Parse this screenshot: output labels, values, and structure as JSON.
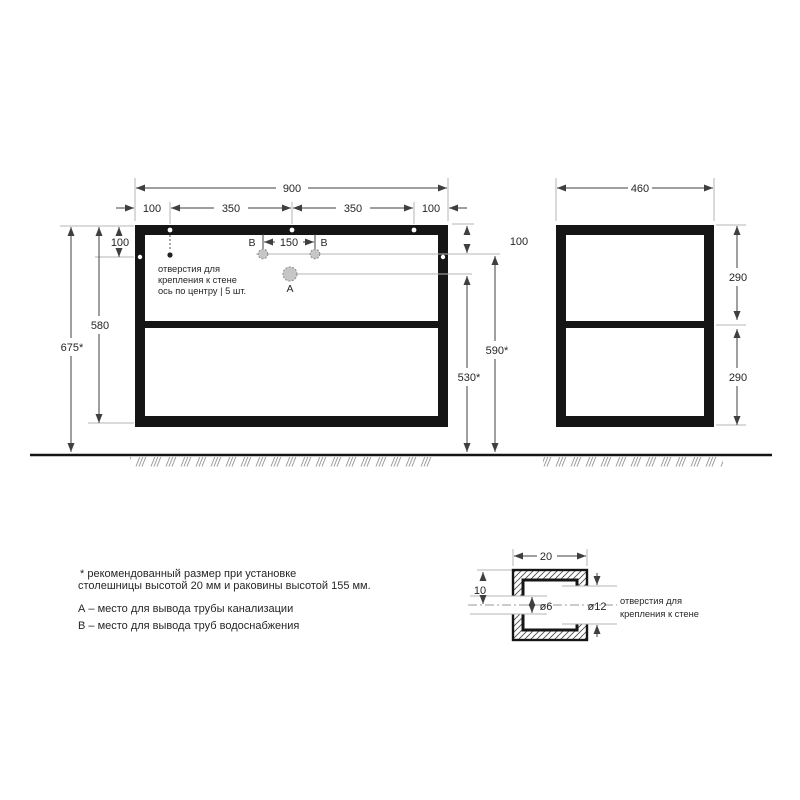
{
  "colors": {
    "outline": "#151515",
    "dim_line": "#3f3f3f",
    "thin_line": "#b5b5b5",
    "text": "#262626",
    "hole_fill": "#c6c6c6",
    "floor_hatch": "#9a9a9a"
  },
  "front_view": {
    "dims": {
      "total_width": "900",
      "segments": [
        "100",
        "350",
        "350",
        "100"
      ],
      "hole_offset_left": "100",
      "hole_offset_right": "100",
      "frame_height": "580",
      "overall_height": "675*",
      "b_height": "590*",
      "a_height": "530*",
      "b_spacing": "150"
    },
    "labels": {
      "b_left": "В",
      "b_right": "В",
      "a_point": "А",
      "holes_note": [
        "отверстия для",
        "крепления к стене",
        "ось по центру   |  5 шт."
      ]
    }
  },
  "side_view": {
    "dims": {
      "width": "460",
      "top_section": "290",
      "bottom_section": "290"
    }
  },
  "detail_view": {
    "dims": {
      "width": "20",
      "to_center": "10",
      "inner_hole": "ø6",
      "outer_hole": "ø12"
    },
    "note": [
      "отверстия для",
      "крепления к стене"
    ]
  },
  "footnotes": {
    "line1": "* рекомендованный размер при установке",
    "line2": "столешницы высотой 20 мм и раковины высотой 155 мм.",
    "line3": "А – место для вывода трубы канализации",
    "line4": "В – место для вывода труб водоснабжения"
  }
}
